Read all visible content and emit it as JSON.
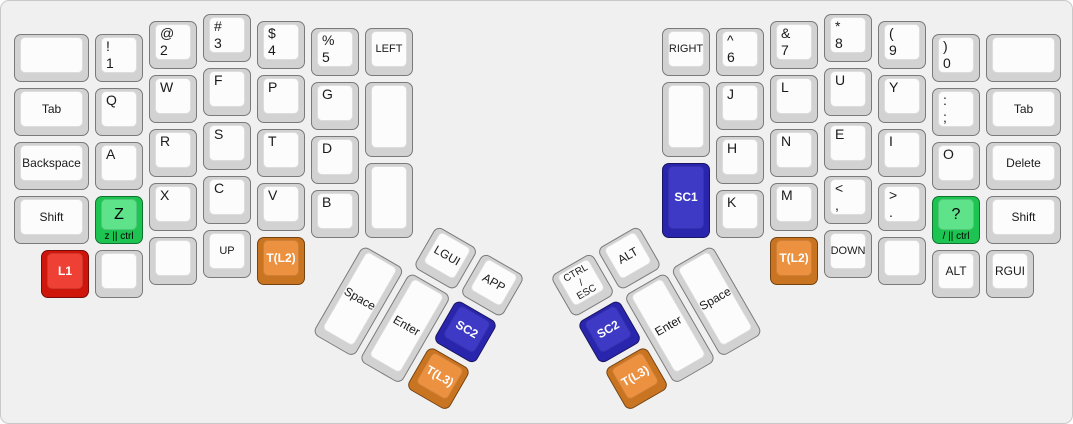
{
  "keyboard": {
    "unit": 54,
    "margin": 10,
    "panel": {
      "background": "#f0f0f0",
      "border": "#c9c9c9"
    },
    "colors": {
      "default": {
        "base": "#d2d2d2",
        "top": "#fcfcfc",
        "text": "#1a1a1a"
      },
      "red": {
        "base": "#cf160c",
        "top": "#ee4034",
        "text": "#ffffff"
      },
      "green": {
        "base": "#1dc452",
        "top": "#5fe38a",
        "text": "#000000"
      },
      "orange": {
        "base": "#c97420",
        "top": "#ec9140",
        "text": "#ffffff"
      },
      "blue": {
        "base": "#2a25ad",
        "top": "#3e3ac6",
        "text": "#ffffff"
      }
    },
    "sections": [
      {
        "id": "left-main",
        "keys": [
          {
            "n": "blank-top-left",
            "x": 0,
            "y": 0.375,
            "w": 1.5
          },
          {
            "n": "tab-left",
            "x": 0,
            "y": 1.375,
            "w": 1.5,
            "l": "Tab",
            "a": "c"
          },
          {
            "n": "backspace",
            "x": 0,
            "y": 2.375,
            "w": 1.5,
            "l": "Backspace",
            "a": "c"
          },
          {
            "n": "shift-left",
            "x": 0,
            "y": 3.375,
            "w": 1.5,
            "l": "Shift",
            "a": "c"
          },
          {
            "n": "l1-layer",
            "x": 0.5,
            "y": 4.375,
            "l": "L1",
            "a": "c",
            "color": "red",
            "bold": true
          },
          {
            "n": "exclam-1",
            "x": 1.5,
            "y": 0.375,
            "t": "!",
            "b": "1"
          },
          {
            "n": "q",
            "x": 1.5,
            "y": 1.375,
            "l": "Q",
            "a": "tl"
          },
          {
            "n": "a",
            "x": 1.5,
            "y": 2.375,
            "l": "A",
            "a": "tl"
          },
          {
            "n": "z-ctrl",
            "x": 1.5,
            "y": 3.375,
            "l": "Z",
            "a": "c",
            "fs": "big",
            "color": "green",
            "front": "z || ctrl"
          },
          {
            "n": "blank-left-bottom-1",
            "x": 1.5,
            "y": 4.375
          },
          {
            "n": "at-2",
            "x": 2.5,
            "y": 0.125,
            "t": "@",
            "b": "2"
          },
          {
            "n": "w",
            "x": 2.5,
            "y": 1.125,
            "l": "W",
            "a": "tl"
          },
          {
            "n": "r",
            "x": 2.5,
            "y": 2.125,
            "l": "R",
            "a": "tl"
          },
          {
            "n": "x",
            "x": 2.5,
            "y": 3.125,
            "l": "X",
            "a": "tl"
          },
          {
            "n": "blank-left-bottom-2",
            "x": 2.5,
            "y": 4.125
          },
          {
            "n": "hash-3",
            "x": 3.5,
            "y": 0,
            "t": "#",
            "b": "3"
          },
          {
            "n": "f",
            "x": 3.5,
            "y": 1,
            "l": "F",
            "a": "tl"
          },
          {
            "n": "s",
            "x": 3.5,
            "y": 2,
            "l": "S",
            "a": "tl"
          },
          {
            "n": "c",
            "x": 3.5,
            "y": 3,
            "l": "C",
            "a": "tl"
          },
          {
            "n": "up-arrow",
            "x": 3.5,
            "y": 4,
            "l": "UP",
            "a": "c",
            "fs": "small"
          },
          {
            "n": "dollar-4",
            "x": 4.5,
            "y": 0.125,
            "t": "$",
            "b": "4"
          },
          {
            "n": "p",
            "x": 4.5,
            "y": 1.125,
            "l": "P",
            "a": "tl"
          },
          {
            "n": "t",
            "x": 4.5,
            "y": 2.125,
            "l": "T",
            "a": "tl"
          },
          {
            "n": "v",
            "x": 4.5,
            "y": 3.125,
            "l": "V",
            "a": "tl"
          },
          {
            "n": "t-l2-left",
            "x": 4.5,
            "y": 4.125,
            "l": "T(L2)",
            "a": "c",
            "color": "orange",
            "bold": true
          },
          {
            "n": "percent-5",
            "x": 5.5,
            "y": 0.25,
            "t": "%",
            "b": "5"
          },
          {
            "n": "g",
            "x": 5.5,
            "y": 1.25,
            "l": "G",
            "a": "tl"
          },
          {
            "n": "d",
            "x": 5.5,
            "y": 2.25,
            "l": "D",
            "a": "tl"
          },
          {
            "n": "b",
            "x": 5.5,
            "y": 3.25,
            "l": "B",
            "a": "tl"
          },
          {
            "n": "left-arrow",
            "x": 6.5,
            "y": 0.25,
            "l": "LEFT",
            "a": "c",
            "fs": "small"
          },
          {
            "n": "blank-left-inner-1",
            "x": 6.5,
            "y": 1.25,
            "h": 1.5
          },
          {
            "n": "blank-left-inner-2",
            "x": 6.5,
            "y": 2.75,
            "h": 1.5
          }
        ]
      },
      {
        "id": "right-main",
        "keys": [
          {
            "n": "right-arrow",
            "x": 12,
            "y": 0.25,
            "l": "RIGHT",
            "a": "c",
            "fs": "small"
          },
          {
            "n": "blank-right-inner-1",
            "x": 12,
            "y": 1.25,
            "h": 1.5
          },
          {
            "n": "sc1",
            "x": 12,
            "y": 2.75,
            "h": 1.5,
            "l": "SC1",
            "a": "c",
            "color": "blue",
            "bold": true
          },
          {
            "n": "caret-6",
            "x": 13,
            "y": 0.25,
            "t": "^",
            "b": "6"
          },
          {
            "n": "j",
            "x": 13,
            "y": 1.25,
            "l": "J",
            "a": "tl"
          },
          {
            "n": "h",
            "x": 13,
            "y": 2.25,
            "l": "H",
            "a": "tl"
          },
          {
            "n": "k",
            "x": 13,
            "y": 3.25,
            "l": "K",
            "a": "tl"
          },
          {
            "n": "amp-7",
            "x": 14,
            "y": 0.125,
            "t": "&",
            "b": "7"
          },
          {
            "n": "l",
            "x": 14,
            "y": 1.125,
            "l": "L",
            "a": "tl"
          },
          {
            "n": "n",
            "x": 14,
            "y": 2.125,
            "l": "N",
            "a": "tl"
          },
          {
            "n": "m",
            "x": 14,
            "y": 3.125,
            "l": "M",
            "a": "tl"
          },
          {
            "n": "t-l2-right",
            "x": 14,
            "y": 4.125,
            "l": "T(L2)",
            "a": "c",
            "color": "orange",
            "bold": true
          },
          {
            "n": "star-8",
            "x": 15,
            "y": 0,
            "t": "*",
            "b": "8"
          },
          {
            "n": "u",
            "x": 15,
            "y": 1,
            "l": "U",
            "a": "tl"
          },
          {
            "n": "e",
            "x": 15,
            "y": 2,
            "l": "E",
            "a": "tl"
          },
          {
            "n": "lt-comma",
            "x": 15,
            "y": 3,
            "t": "<",
            "b": ","
          },
          {
            "n": "down-arrow",
            "x": 15,
            "y": 4,
            "l": "DOWN",
            "a": "c",
            "fs": "small"
          },
          {
            "n": "lparen-9",
            "x": 16,
            "y": 0.125,
            "t": "(",
            "b": "9"
          },
          {
            "n": "y",
            "x": 16,
            "y": 1.125,
            "l": "Y",
            "a": "tl"
          },
          {
            "n": "i",
            "x": 16,
            "y": 2.125,
            "l": "I",
            "a": "tl"
          },
          {
            "n": "gt-period",
            "x": 16,
            "y": 3.125,
            "t": ">",
            "b": "."
          },
          {
            "n": "blank-right-bottom-1",
            "x": 16,
            "y": 4.125
          },
          {
            "n": "rparen-0",
            "x": 17,
            "y": 0.375,
            "t": ")",
            "b": "0"
          },
          {
            "n": "colon-semicolon",
            "x": 17,
            "y": 1.375,
            "t": ":",
            "b": ";"
          },
          {
            "n": "o",
            "x": 17,
            "y": 2.375,
            "l": "O",
            "a": "tl"
          },
          {
            "n": "question-ctrl",
            "x": 17,
            "y": 3.375,
            "l": "?",
            "a": "c",
            "fs": "big",
            "color": "green",
            "front": "/ || ctrl"
          },
          {
            "n": "alt-right",
            "x": 17,
            "y": 4.375,
            "l": "ALT",
            "a": "c"
          },
          {
            "n": "blank-top-right",
            "x": 18,
            "y": 0.375,
            "w": 1.5
          },
          {
            "n": "tab-right",
            "x": 18,
            "y": 1.375,
            "w": 1.5,
            "l": "Tab",
            "a": "c"
          },
          {
            "n": "delete",
            "x": 18,
            "y": 2.375,
            "w": 1.5,
            "l": "Delete",
            "a": "c"
          },
          {
            "n": "shift-right",
            "x": 18,
            "y": 3.375,
            "w": 1.5,
            "l": "Shift",
            "a": "c"
          },
          {
            "n": "rgui",
            "x": 18,
            "y": 4.375,
            "l": "RGUI",
            "a": "c"
          }
        ]
      },
      {
        "id": "left-thumb",
        "rotate": 30,
        "origin": {
          "x": 6.5,
          "y": 4.25
        },
        "keys": [
          {
            "n": "lgui",
            "x": 1,
            "y": -1,
            "l": "LGUI",
            "a": "c"
          },
          {
            "n": "app",
            "x": 2,
            "y": -1,
            "l": "APP",
            "a": "c"
          },
          {
            "n": "space-left",
            "x": 0,
            "y": 0,
            "h": 2,
            "l": "Space",
            "a": "c"
          },
          {
            "n": "enter-left",
            "x": 1,
            "y": 0,
            "h": 2,
            "l": "Enter",
            "a": "c"
          },
          {
            "n": "sc2-left",
            "x": 2,
            "y": 0,
            "l": "SC2",
            "a": "c",
            "color": "blue",
            "bold": true
          },
          {
            "n": "t-l3-left",
            "x": 2,
            "y": 1,
            "l": "T(L3)",
            "a": "c",
            "color": "orange",
            "bold": true
          }
        ]
      },
      {
        "id": "right-thumb",
        "rotate": -30,
        "origin": {
          "x": 13,
          "y": 4.25
        },
        "keys": [
          {
            "n": "ctrl-esc",
            "x": -3,
            "y": -1,
            "l": "CTRL\n/\nESC",
            "a": "c",
            "fs": "multi"
          },
          {
            "n": "alt-thumb",
            "x": -2,
            "y": -1,
            "l": "ALT",
            "a": "c"
          },
          {
            "n": "sc2-right",
            "x": -3,
            "y": 0,
            "l": "SC2",
            "a": "c",
            "color": "blue",
            "bold": true
          },
          {
            "n": "enter-right",
            "x": -2,
            "y": 0,
            "h": 2,
            "l": "Enter",
            "a": "c"
          },
          {
            "n": "space-right",
            "x": -1,
            "y": 0,
            "h": 2,
            "l": "Space",
            "a": "c"
          },
          {
            "n": "t-l3-right",
            "x": -3,
            "y": 1,
            "l": "T(L3)",
            "a": "c",
            "color": "orange",
            "bold": true
          }
        ]
      }
    ]
  }
}
